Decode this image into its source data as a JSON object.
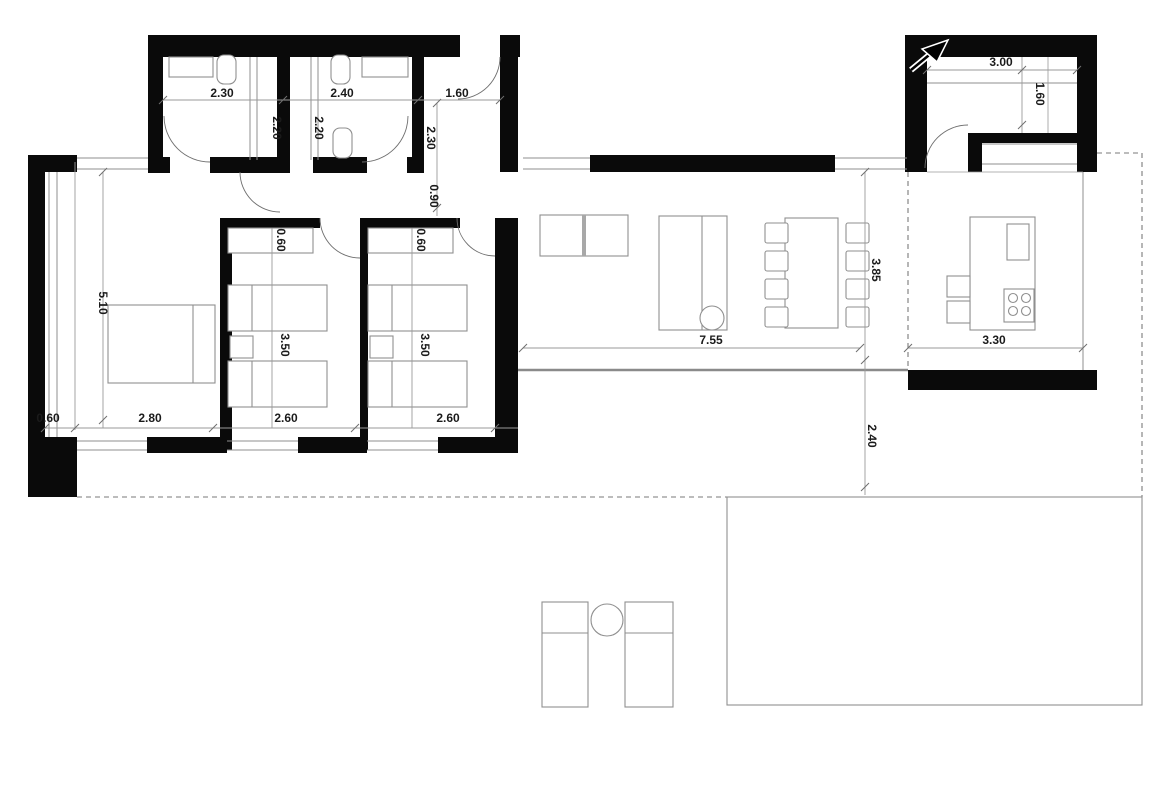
{
  "colors": {
    "wall": "#0a0a0a",
    "thin_line": "#8f8f8f",
    "dashed_line": "#7a7a7a",
    "label_text": "#1b1b1b",
    "background": "#ffffff"
  },
  "rooms": {
    "bathroom_1": {
      "width": "2.30",
      "depth": "2.20"
    },
    "bathroom_2": {
      "width": "2.40",
      "depth": "2.20"
    },
    "entry": {
      "width": "1.60",
      "depth": "2.30"
    },
    "hallway": {
      "width": "0.90"
    },
    "master_bedroom": {
      "length": "5.10",
      "width": "2.80",
      "side_strip": "0.60"
    },
    "bedroom_2": {
      "wardrobe": "0.60",
      "length": "3.50",
      "width": "2.60"
    },
    "bedroom_3": {
      "wardrobe": "0.60",
      "length": "3.50",
      "width": "2.60"
    },
    "living_dining": {
      "width": "7.55",
      "depth": "3.85"
    },
    "kitchen": {
      "width": "3.30"
    },
    "utility_room": {
      "width": "3.00",
      "depth": "1.60"
    },
    "south_terrace": {
      "depth": "2.40"
    }
  }
}
